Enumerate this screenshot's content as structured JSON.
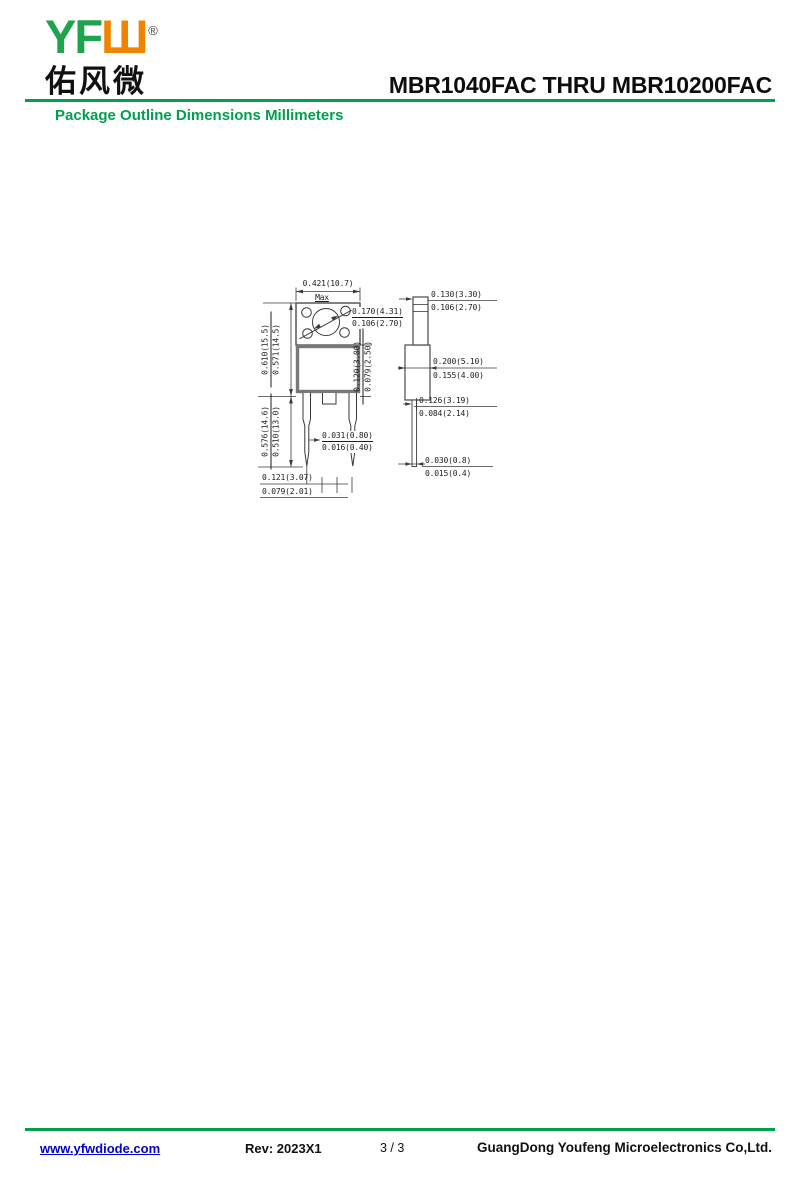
{
  "logo": {
    "text_green": "YF",
    "text_orange": "Ш",
    "registered": "®",
    "chinese": "佑风微"
  },
  "header": {
    "title": "MBR1040FAC THRU MBR10200FAC",
    "subtitle": "Package Outline Dimensions Millimeters"
  },
  "colors": {
    "accent_green": "#00a04d",
    "logo_orange": "#f08300",
    "link_blue": "#0000cc"
  },
  "drawing": {
    "front_view": {
      "width_max": {
        "value": "0.421(10.7)",
        "note": "Max"
      },
      "hole_diameter": {
        "upper": "0.170(4.31)",
        "lower": "0.106(2.70)"
      },
      "body_height": {
        "upper": "0.610(15.5)",
        "lower": "0.571(14.5)"
      },
      "lead_length": {
        "upper": "0.576(14.6)",
        "lower": "0.510(13.0)"
      },
      "body_lower_height": {
        "upper": "0.120(3.00)",
        "lower": "0.079(2.50)"
      },
      "lead_width": {
        "upper": "0.031(0.80)",
        "lower": "0.016(0.40)"
      },
      "lead_pitch": {
        "upper": "0.121(3.07)",
        "lower": "0.079(2.01)"
      }
    },
    "side_view": {
      "tab_thickness": {
        "upper": "0.130(3.30)",
        "lower": "0.106(2.70)"
      },
      "body_thickness": {
        "upper": "0.200(5.10)",
        "lower": "0.155(4.00)"
      },
      "lead_offset": {
        "upper": "0.126(3.19)",
        "lower": "0.084(2.14)"
      },
      "lead_thickness": {
        "upper": "0.030(0.8)",
        "lower": "0.015(0.4)"
      }
    }
  },
  "footer": {
    "url": "www.yfwdiode.com",
    "rev": "Rev: 2023X1",
    "page": "3 / 3",
    "company": "GuangDong Youfeng Microelectronics Co,Ltd."
  }
}
